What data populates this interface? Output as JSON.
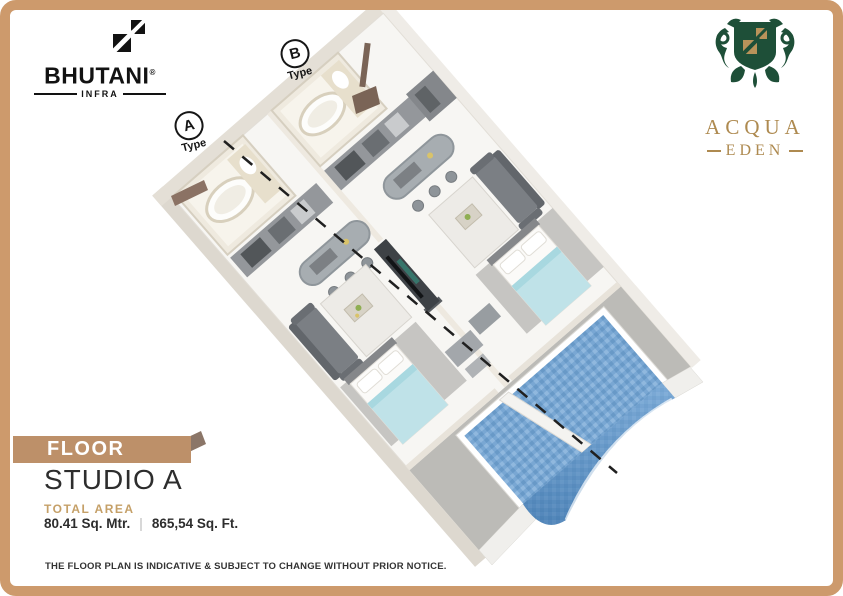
{
  "brand": {
    "name": "BHUTANI",
    "registered": "®",
    "sub": "INFRA"
  },
  "project": {
    "name": "ACQUA",
    "name_line2": "EDEN"
  },
  "plan": {
    "type_labels": [
      {
        "letter": "A",
        "word": "Type"
      },
      {
        "letter": "B",
        "word": "Type"
      }
    ]
  },
  "info": {
    "banner": "FLOOR PLAN",
    "title": "STUDIO A",
    "total_area_label": "TOTAL AREA",
    "area_metric": "80.41 Sq. Mtr.",
    "separator": "|",
    "area_imperial": "865,54 Sq. Ft."
  },
  "disclaimer": "THE FLOOR PLAN IS INDICATIVE & SUBJECT TO CHANGE WITHOUT PRIOR NOTICE.",
  "colors": {
    "frame_tan": "#cd9a6c",
    "banner_tan": "#bd9069",
    "accent_tan": "#c5a068",
    "brand_green": "#1e4f38",
    "brand_gold": "#ae8a50",
    "pool_blue": "#79a7d3",
    "bed_blue": "#bfe2e8",
    "text_dark": "#2d2d2d"
  }
}
